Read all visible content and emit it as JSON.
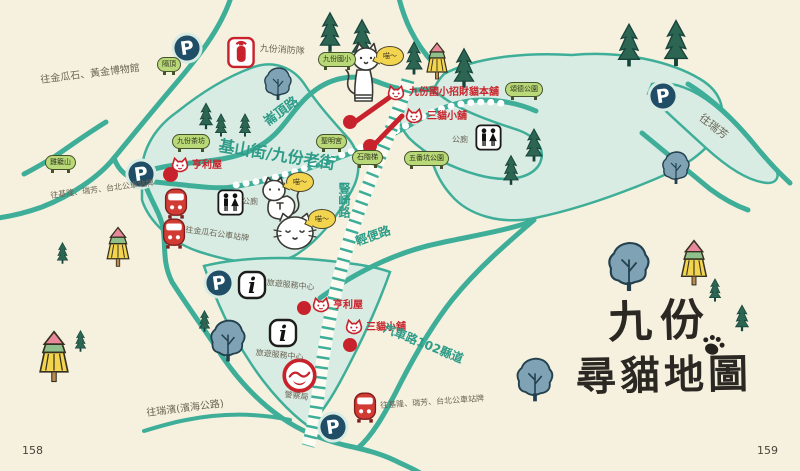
{
  "page": {
    "left_number": "158",
    "right_number": "159"
  },
  "title": {
    "line1": "九份",
    "line2": "尋貓地圖"
  },
  "colors": {
    "background": "#f6f1df",
    "road": "#3fae99",
    "block_fill": "#d9ece3",
    "red": "#c8232c",
    "parking_navy": "#1f4e66",
    "plaque_green": "#b9d878",
    "bubble_yellow": "#f2d44f"
  },
  "road_labels": [
    {
      "text": "崙頂路",
      "x": 262,
      "y": 118,
      "rot": -36,
      "size": 13
    },
    {
      "text": "基山街/九份老街",
      "x": 220,
      "y": 138,
      "rot": 9,
      "size": 16
    },
    {
      "text": "豎崎路",
      "x": 338,
      "y": 182,
      "rot": 0,
      "size": 12,
      "vertical": true
    },
    {
      "text": "輕便路",
      "x": 354,
      "y": 236,
      "rot": -19,
      "size": 12
    },
    {
      "text": "汽車路102縣道",
      "x": 386,
      "y": 322,
      "rot": 22,
      "size": 12
    }
  ],
  "direction_labels": [
    {
      "text": "往金瓜石、黃金博物館",
      "x": 40,
      "y": 76,
      "rot": -7,
      "size": 10
    },
    {
      "text": "九份消防隊",
      "x": 260,
      "y": 45,
      "rot": 4,
      "size": 9
    },
    {
      "text": "往基隆、瑞芳、台北公車站牌",
      "x": 50,
      "y": 192,
      "rot": -7,
      "size": 8
    },
    {
      "text": "往金瓜石公車站牌",
      "x": 186,
      "y": 226,
      "rot": 8,
      "size": 8
    },
    {
      "text": "公廁",
      "x": 242,
      "y": 198,
      "rot": 0,
      "size": 8
    },
    {
      "text": "公廁",
      "x": 452,
      "y": 136,
      "rot": 0,
      "size": 8
    },
    {
      "text": "旅遊服務中心",
      "x": 267,
      "y": 279,
      "rot": 6,
      "size": 8
    },
    {
      "text": "旅遊服務中心",
      "x": 256,
      "y": 349,
      "rot": 6,
      "size": 8
    },
    {
      "text": "警察局",
      "x": 285,
      "y": 391,
      "rot": 7,
      "size": 8
    },
    {
      "text": "往基隆、瑞芳、台北公車站牌",
      "x": 380,
      "y": 402,
      "rot": -4,
      "size": 8
    },
    {
      "text": "往瑞濱(濱海公路)",
      "x": 146,
      "y": 409,
      "rot": -7,
      "size": 10
    },
    {
      "text": "往瑞芳",
      "x": 704,
      "y": 112,
      "rot": 38,
      "size": 11
    }
  ],
  "shops": [
    {
      "label": "九份國小招財貓本舖",
      "icon": "lucky-cat-shop-icon",
      "ix": 386,
      "iy": 84,
      "lx": 409,
      "ly": 88
    },
    {
      "label": "三貓小舖",
      "icon": "lucky-cat-shop-icon",
      "ix": 404,
      "iy": 107,
      "lx": 427,
      "ly": 112
    },
    {
      "label": "亨利屋",
      "icon": "lucky-cat-shop-icon",
      "ix": 170,
      "iy": 156,
      "lx": 192,
      "ly": 161
    },
    {
      "label": "亨利屋",
      "icon": "lucky-cat-shop-icon",
      "ix": 311,
      "iy": 296,
      "lx": 333,
      "ly": 301
    },
    {
      "label": "三貓小舖",
      "icon": "lucky-cat-shop-icon",
      "ix": 344,
      "iy": 318,
      "lx": 366,
      "ly": 323
    }
  ],
  "plaques": [
    {
      "text": "隔頂",
      "x": 157,
      "y": 57
    },
    {
      "text": "九份國小",
      "x": 318,
      "y": 52
    },
    {
      "text": "頌德公園",
      "x": 505,
      "y": 82
    },
    {
      "text": "九份茶坊",
      "x": 172,
      "y": 134
    },
    {
      "text": "聖明宮",
      "x": 316,
      "y": 134
    },
    {
      "text": "雞籠山",
      "x": 45,
      "y": 155
    },
    {
      "text": "五番坑公園",
      "x": 404,
      "y": 151
    },
    {
      "text": "石階梯",
      "x": 352,
      "y": 150
    }
  ],
  "speech_bubbles": [
    {
      "text": "喵～",
      "x": 376,
      "y": 46
    },
    {
      "text": "喵～",
      "x": 286,
      "y": 172
    },
    {
      "text": "喵～",
      "x": 308,
      "y": 209
    }
  ],
  "markers": [
    {
      "type": "parking",
      "icon": "parking-icon",
      "x": 170,
      "y": 31
    },
    {
      "type": "parking",
      "icon": "parking-icon",
      "x": 124,
      "y": 157
    },
    {
      "type": "parking",
      "icon": "parking-icon",
      "x": 202,
      "y": 266
    },
    {
      "type": "parking",
      "icon": "parking-icon",
      "x": 316,
      "y": 410
    },
    {
      "type": "parking",
      "icon": "parking-icon",
      "x": 646,
      "y": 79
    },
    {
      "type": "info",
      "icon": "tourist-info-icon",
      "x": 237,
      "y": 270
    },
    {
      "type": "info",
      "icon": "tourist-info-icon",
      "x": 268,
      "y": 318
    },
    {
      "type": "restroom",
      "icon": "restroom-icon",
      "x": 217,
      "y": 189
    },
    {
      "type": "restroom",
      "icon": "restroom-icon",
      "x": 475,
      "y": 124
    },
    {
      "type": "bus",
      "icon": "bus-stop-icon",
      "x": 163,
      "y": 186
    },
    {
      "type": "bus",
      "icon": "bus-stop-icon",
      "x": 161,
      "y": 216
    },
    {
      "type": "bus",
      "icon": "bus-stop-icon",
      "x": 352,
      "y": 390
    },
    {
      "type": "fire",
      "icon": "fire-station-icon",
      "x": 227,
      "y": 36
    },
    {
      "type": "police",
      "icon": "police-station-icon",
      "x": 281,
      "y": 357
    },
    {
      "type": "dot",
      "icon": "location-dot",
      "x": 163,
      "y": 167,
      "s": 15
    },
    {
      "type": "dot",
      "icon": "location-dot",
      "x": 343,
      "y": 115,
      "s": 14
    },
    {
      "type": "dot",
      "icon": "location-dot",
      "x": 363,
      "y": 139,
      "s": 14
    },
    {
      "type": "dot",
      "icon": "location-dot",
      "x": 297,
      "y": 301,
      "s": 14
    },
    {
      "type": "dot",
      "icon": "location-dot",
      "x": 343,
      "y": 338,
      "s": 14
    }
  ],
  "cats": [
    {
      "pose": "standing",
      "x": 344,
      "y": 42,
      "w": 38,
      "h": 70
    },
    {
      "pose": "sitting",
      "x": 256,
      "y": 176,
      "w": 46,
      "h": 46
    },
    {
      "pose": "round",
      "x": 272,
      "y": 210,
      "w": 46,
      "h": 42
    }
  ],
  "trees": [
    {
      "type": "conifer",
      "x": 318,
      "y": 8,
      "w": 24,
      "h": 48
    },
    {
      "type": "conifer",
      "x": 350,
      "y": 14,
      "w": 24,
      "h": 50
    },
    {
      "type": "conifer",
      "x": 404,
      "y": 38,
      "w": 20,
      "h": 40
    },
    {
      "type": "conifer",
      "x": 452,
      "y": 42,
      "w": 24,
      "h": 52
    },
    {
      "type": "conifer",
      "x": 198,
      "y": 98,
      "w": 16,
      "h": 36
    },
    {
      "type": "conifer",
      "x": 214,
      "y": 110,
      "w": 14,
      "h": 30
    },
    {
      "type": "conifer",
      "x": 238,
      "y": 110,
      "w": 14,
      "h": 30
    },
    {
      "type": "conifer",
      "x": 524,
      "y": 122,
      "w": 20,
      "h": 46
    },
    {
      "type": "conifer",
      "x": 502,
      "y": 150,
      "w": 18,
      "h": 40
    },
    {
      "type": "conifer",
      "x": 616,
      "y": 16,
      "w": 26,
      "h": 58
    },
    {
      "type": "conifer",
      "x": 662,
      "y": 12,
      "w": 28,
      "h": 62
    },
    {
      "type": "conifer",
      "x": 708,
      "y": 276,
      "w": 14,
      "h": 28
    },
    {
      "type": "conifer",
      "x": 734,
      "y": 300,
      "w": 16,
      "h": 36
    },
    {
      "type": "conifer",
      "x": 56,
      "y": 240,
      "w": 13,
      "h": 26
    },
    {
      "type": "conifer",
      "x": 74,
      "y": 326,
      "w": 13,
      "h": 30
    },
    {
      "type": "conifer",
      "x": 198,
      "y": 304,
      "w": 13,
      "h": 34
    },
    {
      "type": "blue",
      "x": 262,
      "y": 66,
      "w": 32,
      "h": 36
    },
    {
      "type": "blue",
      "x": 660,
      "y": 150,
      "w": 32,
      "h": 36
    },
    {
      "type": "blue",
      "x": 606,
      "y": 240,
      "w": 46,
      "h": 54
    },
    {
      "type": "blue",
      "x": 514,
      "y": 356,
      "w": 42,
      "h": 48
    },
    {
      "type": "blue",
      "x": 208,
      "y": 318,
      "w": 40,
      "h": 46
    },
    {
      "type": "colorful",
      "x": 424,
      "y": 42,
      "w": 26,
      "h": 40
    },
    {
      "type": "colorful",
      "x": 678,
      "y": 238,
      "w": 32,
      "h": 52
    },
    {
      "type": "colorful",
      "x": 36,
      "y": 330,
      "w": 36,
      "h": 56
    },
    {
      "type": "colorful",
      "x": 104,
      "y": 226,
      "w": 28,
      "h": 44
    }
  ]
}
